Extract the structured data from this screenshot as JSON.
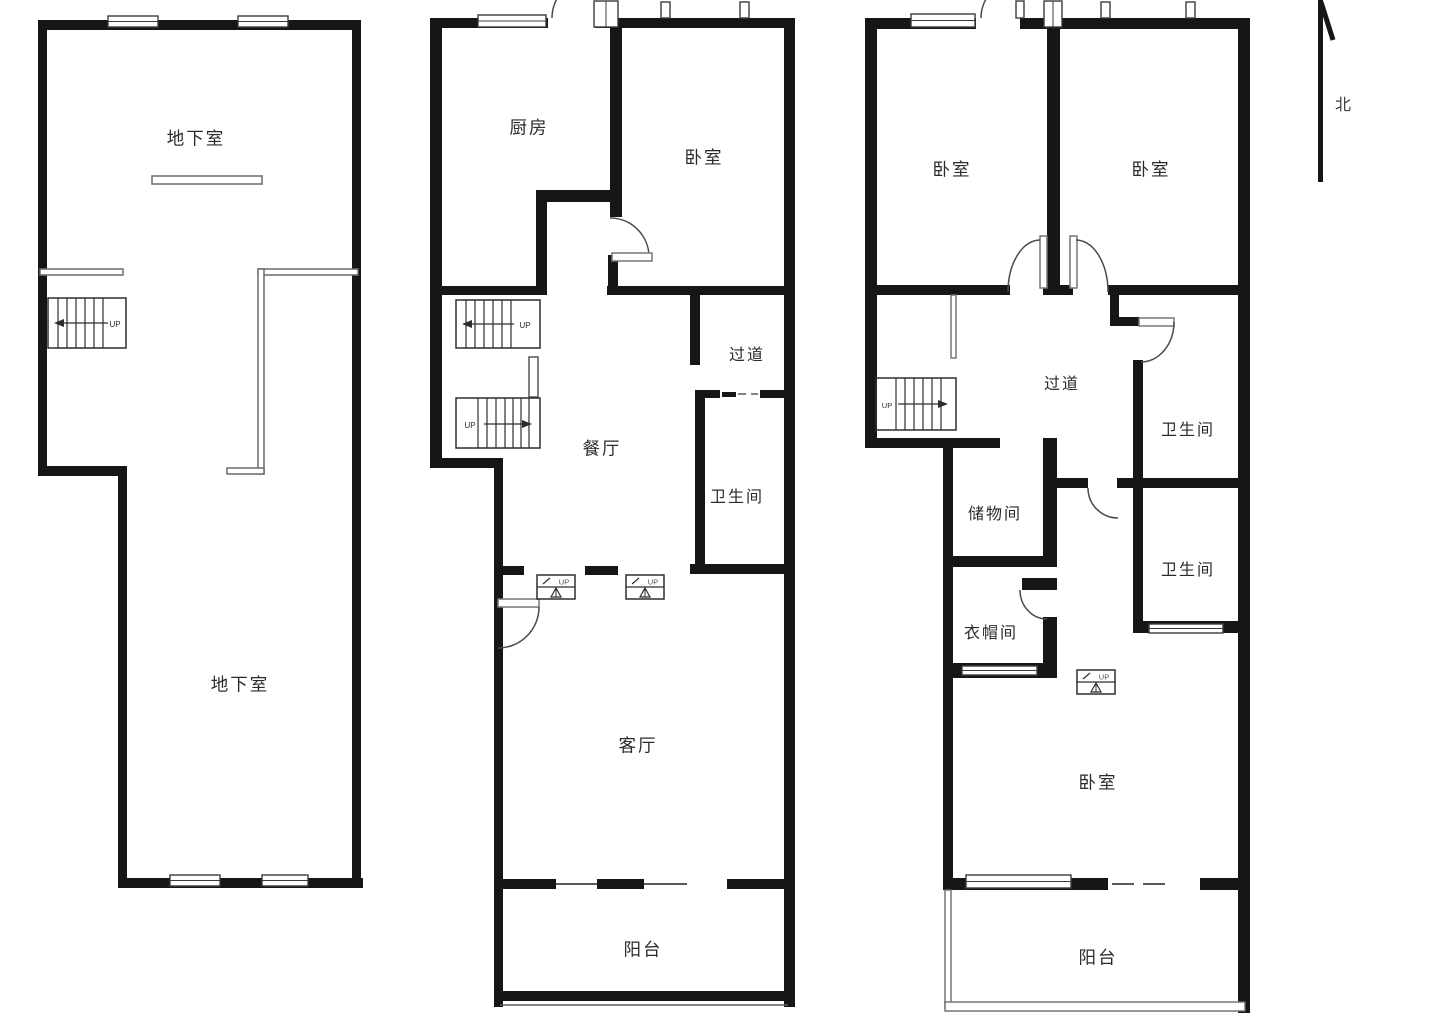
{
  "compass": {
    "label": "北"
  },
  "stairs": {
    "up_label": "UP"
  },
  "plans": [
    {
      "name": "basement-plan",
      "rooms": [
        "地下室",
        "地下室"
      ]
    },
    {
      "name": "main-floor-plan",
      "rooms": [
        "厨房",
        "卧室",
        "过道",
        "餐厅",
        "卫生间",
        "客厅",
        "阳台"
      ]
    },
    {
      "name": "upper-floor-plan",
      "rooms": [
        "卧室",
        "卧室",
        "过道",
        "卫生间",
        "储物间",
        "卫生间",
        "衣帽间",
        "卧室",
        "阳台"
      ]
    }
  ]
}
